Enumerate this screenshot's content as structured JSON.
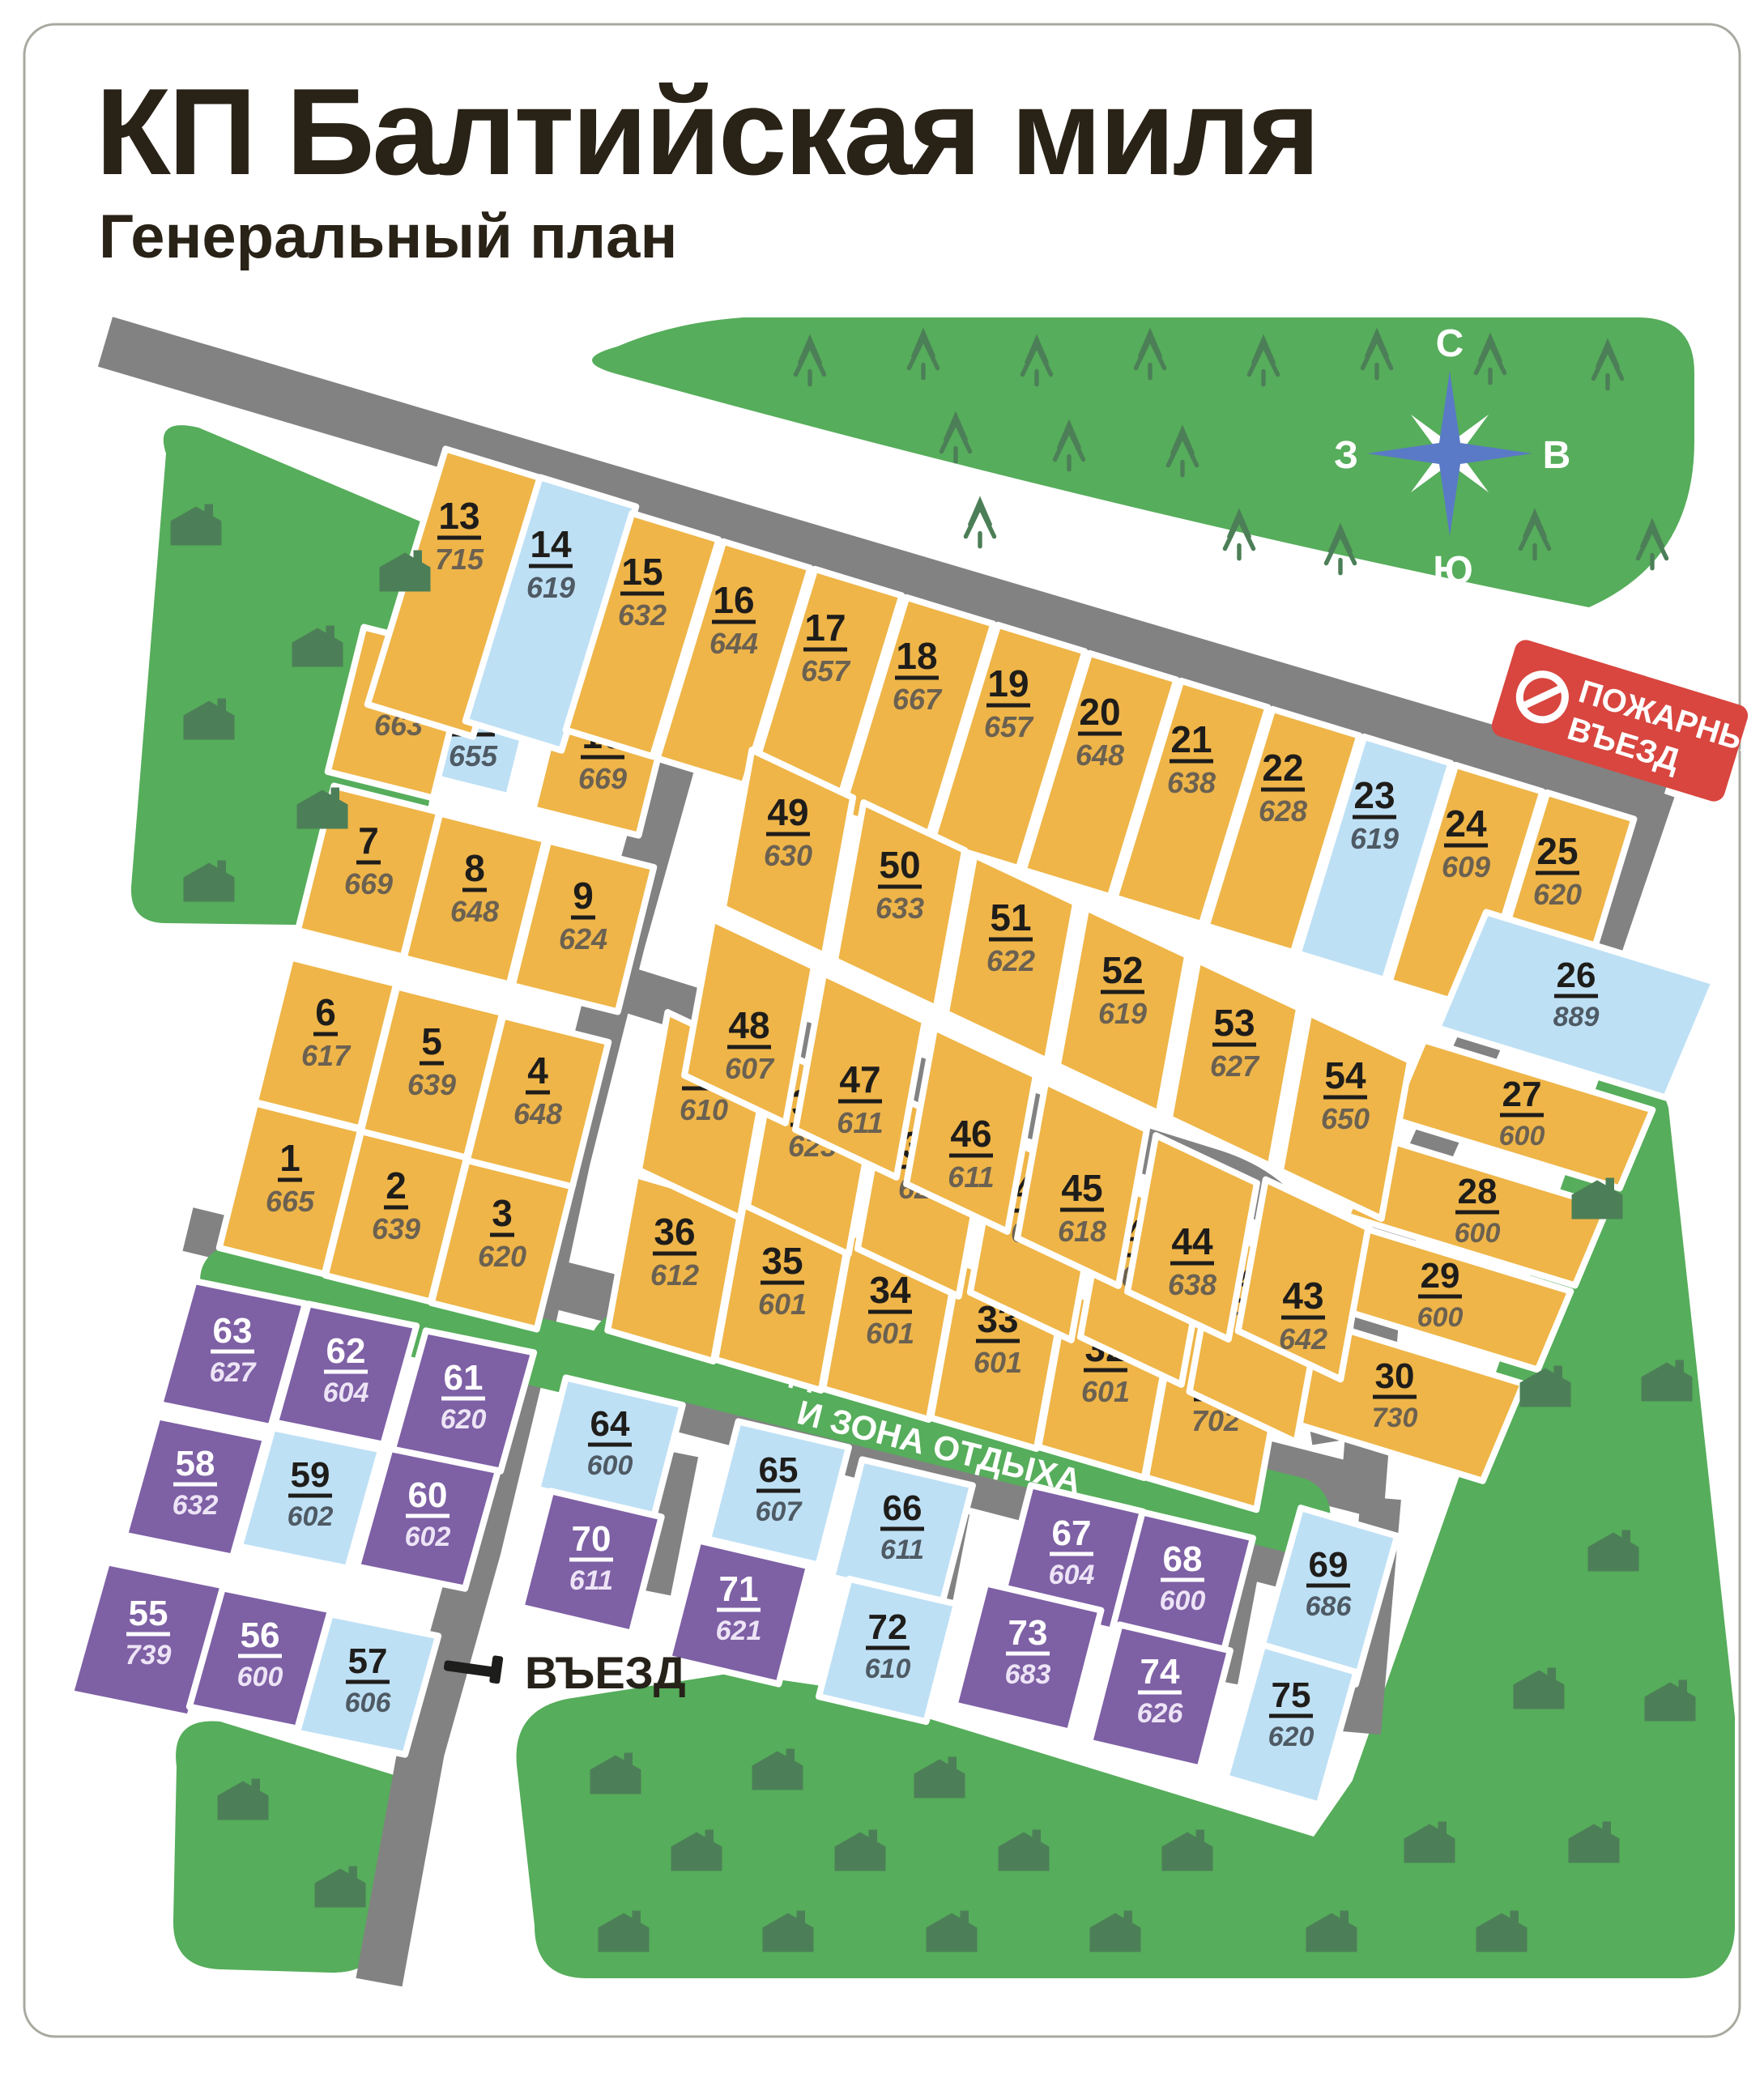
{
  "title": "КП Балтийская миля",
  "subtitle": "Генеральный план",
  "compass": {
    "north": "С",
    "south": "Ю",
    "west": "З",
    "east": "В"
  },
  "fire_entrance_sign": {
    "line1": "ПОЖАРНЫЙ",
    "line2": "ВЪЕЗД"
  },
  "entrance_label": "ВЪЕЗД",
  "playground_label": {
    "line1": "ДЕТСКАЯ ПЛОЩАДКА",
    "line2": "И ЗОНА ОТДЫХА"
  },
  "colors": {
    "lot_orange": "#EFB548",
    "lot_blue": "#BEE0F5",
    "lot_purple": "#7E60A5",
    "green_area": "#56AD5B",
    "icon_green": "#4C7F57",
    "road_gray": "#828282",
    "fire_red": "#D8463F",
    "compass_blue": "#5A7AC7"
  },
  "lots": [
    {
      "n": "1",
      "area": "665",
      "status": "orange"
    },
    {
      "n": "2",
      "area": "639",
      "status": "orange"
    },
    {
      "n": "3",
      "area": "620",
      "status": "orange"
    },
    {
      "n": "4",
      "area": "648",
      "status": "orange"
    },
    {
      "n": "5",
      "area": "639",
      "status": "orange"
    },
    {
      "n": "6",
      "area": "617",
      "status": "orange"
    },
    {
      "n": "7",
      "area": "669",
      "status": "orange"
    },
    {
      "n": "8",
      "area": "648",
      "status": "orange"
    },
    {
      "n": "9",
      "area": "624",
      "status": "orange"
    },
    {
      "n": "10",
      "area": "669",
      "status": "orange"
    },
    {
      "n": "11",
      "area": "655",
      "status": "blue"
    },
    {
      "n": "12",
      "area": "663",
      "status": "orange"
    },
    {
      "n": "13",
      "area": "715",
      "status": "orange"
    },
    {
      "n": "14",
      "area": "619",
      "status": "blue"
    },
    {
      "n": "15",
      "area": "632",
      "status": "orange"
    },
    {
      "n": "16",
      "area": "644",
      "status": "orange"
    },
    {
      "n": "17",
      "area": "657",
      "status": "orange"
    },
    {
      "n": "18",
      "area": "667",
      "status": "orange"
    },
    {
      "n": "19",
      "area": "657",
      "status": "orange"
    },
    {
      "n": "20",
      "area": "648",
      "status": "orange"
    },
    {
      "n": "21",
      "area": "638",
      "status": "orange"
    },
    {
      "n": "22",
      "area": "628",
      "status": "orange"
    },
    {
      "n": "23",
      "area": "619",
      "status": "blue"
    },
    {
      "n": "24",
      "area": "609",
      "status": "orange"
    },
    {
      "n": "25",
      "area": "620",
      "status": "orange"
    },
    {
      "n": "26",
      "area": "889",
      "status": "blue"
    },
    {
      "n": "27",
      "area": "600",
      "status": "orange"
    },
    {
      "n": "28",
      "area": "600",
      "status": "orange"
    },
    {
      "n": "29",
      "area": "600",
      "status": "orange"
    },
    {
      "n": "30",
      "area": "730",
      "status": "orange"
    },
    {
      "n": "31",
      "area": "702",
      "status": "orange"
    },
    {
      "n": "32",
      "area": "601",
      "status": "orange"
    },
    {
      "n": "33",
      "area": "601",
      "status": "orange"
    },
    {
      "n": "34",
      "area": "601",
      "status": "orange"
    },
    {
      "n": "35",
      "area": "601",
      "status": "orange"
    },
    {
      "n": "36",
      "area": "612",
      "status": "orange"
    },
    {
      "n": "37",
      "area": "610",
      "status": "orange"
    },
    {
      "n": "38",
      "area": "623",
      "status": "orange"
    },
    {
      "n": "39",
      "area": "623",
      "status": "orange"
    },
    {
      "n": "40",
      "area": "623",
      "status": "orange"
    },
    {
      "n": "41",
      "area": "623",
      "status": "orange"
    },
    {
      "n": "42",
      "area": "786",
      "status": "orange"
    },
    {
      "n": "43",
      "area": "642",
      "status": "orange"
    },
    {
      "n": "44",
      "area": "638",
      "status": "orange"
    },
    {
      "n": "45",
      "area": "618",
      "status": "orange"
    },
    {
      "n": "46",
      "area": "611",
      "status": "orange"
    },
    {
      "n": "47",
      "area": "611",
      "status": "orange"
    },
    {
      "n": "48",
      "area": "607",
      "status": "orange"
    },
    {
      "n": "49",
      "area": "630",
      "status": "orange"
    },
    {
      "n": "50",
      "area": "633",
      "status": "orange"
    },
    {
      "n": "51",
      "area": "622",
      "status": "orange"
    },
    {
      "n": "52",
      "area": "619",
      "status": "orange"
    },
    {
      "n": "53",
      "area": "627",
      "status": "orange"
    },
    {
      "n": "54",
      "area": "650",
      "status": "orange"
    },
    {
      "n": "55",
      "area": "739",
      "status": "purple"
    },
    {
      "n": "56",
      "area": "600",
      "status": "purple"
    },
    {
      "n": "57",
      "area": "606",
      "status": "blue"
    },
    {
      "n": "58",
      "area": "632",
      "status": "purple"
    },
    {
      "n": "59",
      "area": "602",
      "status": "blue"
    },
    {
      "n": "60",
      "area": "602",
      "status": "purple"
    },
    {
      "n": "61",
      "area": "620",
      "status": "purple"
    },
    {
      "n": "62",
      "area": "604",
      "status": "purple"
    },
    {
      "n": "63",
      "area": "627",
      "status": "purple"
    },
    {
      "n": "64",
      "area": "600",
      "status": "blue"
    },
    {
      "n": "65",
      "area": "607",
      "status": "blue"
    },
    {
      "n": "66",
      "area": "611",
      "status": "blue"
    },
    {
      "n": "67",
      "area": "604",
      "status": "purple"
    },
    {
      "n": "68",
      "area": "600",
      "status": "purple"
    },
    {
      "n": "69",
      "area": "686",
      "status": "blue"
    },
    {
      "n": "70",
      "area": "611",
      "status": "purple"
    },
    {
      "n": "71",
      "area": "621",
      "status": "purple"
    },
    {
      "n": "72",
      "area": "610",
      "status": "blue"
    },
    {
      "n": "73",
      "area": "683",
      "status": "purple"
    },
    {
      "n": "74",
      "area": "626",
      "status": "purple"
    },
    {
      "n": "75",
      "area": "620",
      "status": "blue"
    }
  ]
}
